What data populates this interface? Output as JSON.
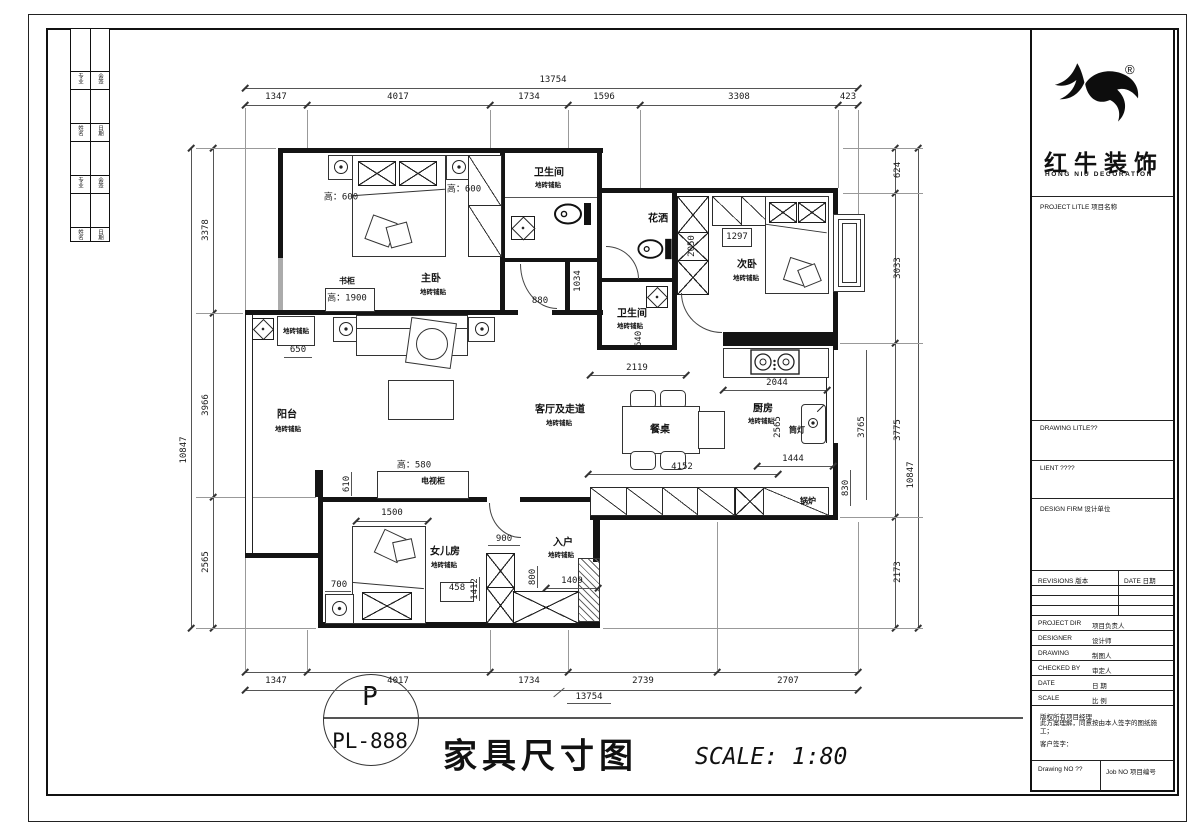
{
  "frame": {
    "sidebar_cells": [
      [
        "专业",
        "会签"
      ],
      [
        "姓名",
        "日期"
      ],
      [
        "专业",
        "会签"
      ],
      [
        "姓名",
        "日期"
      ]
    ]
  },
  "brand": {
    "cn": "红牛装饰",
    "en": "HONG NIU DECORATION",
    "reg": "®"
  },
  "tb": {
    "project": "PROJECT LITLE 项目名称",
    "drawing": "DRAWING LITLE??",
    "client": "LIENT ????",
    "firm": "DESIGN FIRM 设计单位",
    "rev": "REVISIONS 版本",
    "date_col": "DATE 日期",
    "rows": [
      {
        "en": "PROJECT DIR",
        "cn": "项目负责人"
      },
      {
        "en": "DESIGNER",
        "cn": "设计师"
      },
      {
        "en": "DRAWING",
        "cn": "制图人"
      },
      {
        "en": "CHECKED BY",
        "cn": "审定人"
      },
      {
        "en": "DATE",
        "cn": "日 期"
      },
      {
        "en": "SCALE",
        "cn": "比 例"
      }
    ],
    "disc1": "版权所有项目经理",
    "disc2": "此方案理解，同意按由本人签字的图纸施工；",
    "disc3": "客户签字：",
    "dno": "Drawing NO ??",
    "jno": "Job NO 项目编号"
  },
  "stamp": {
    "p": "P",
    "code": "PL-888",
    "title": "家具尺寸图",
    "scale": "SCALE: 1:80"
  },
  "dims": {
    "top": {
      "overall": "13754",
      "segs": [
        "1347",
        "4017",
        "1734",
        "1596",
        "3308",
        "423"
      ]
    },
    "bottom": {
      "overall": "13754",
      "segs": [
        "1347",
        "4017",
        "1734",
        "2739",
        "2707"
      ]
    },
    "left": {
      "overall": "10847",
      "segs": [
        "3378",
        "3966",
        "2565"
      ]
    },
    "right": {
      "overall": "10847",
      "segs": [
        "624",
        "3033",
        "3775",
        "2173"
      ]
    }
  },
  "plan": {
    "fin": "地砖铺贴",
    "labels": {
      "master": "主卧",
      "bath1": "卫生间",
      "shower": "花洒",
      "bath2": "卫生间",
      "second": "次卧",
      "living": "客厅及走道",
      "kitchen": "厨房",
      "balcony": "阳台",
      "daughter": "女儿房",
      "entry": "入户",
      "table": "餐桌",
      "tv": "电视柜",
      "tv_h": "高：580",
      "bookcase": "书柜",
      "bookcase_h": "高：1900",
      "boiler": "锅炉",
      "light": "筒灯",
      "h600a": "高：600",
      "h600b": "高：600"
    },
    "d": {
      "n650": "650",
      "n880": "880",
      "n1034": "1034",
      "n2050": "2050",
      "n1297": "1297",
      "n640": "640",
      "n2119": "2119",
      "n2044": "2044",
      "n2565": "2565",
      "n3765": "3765",
      "n1444": "1444",
      "n830": "830",
      "n4152": "4152",
      "n610": "610",
      "n1500": "1500",
      "n700": "700",
      "n458": "458",
      "n1412": "1412",
      "n900": "900",
      "n800": "800",
      "n1409": "1409"
    }
  }
}
